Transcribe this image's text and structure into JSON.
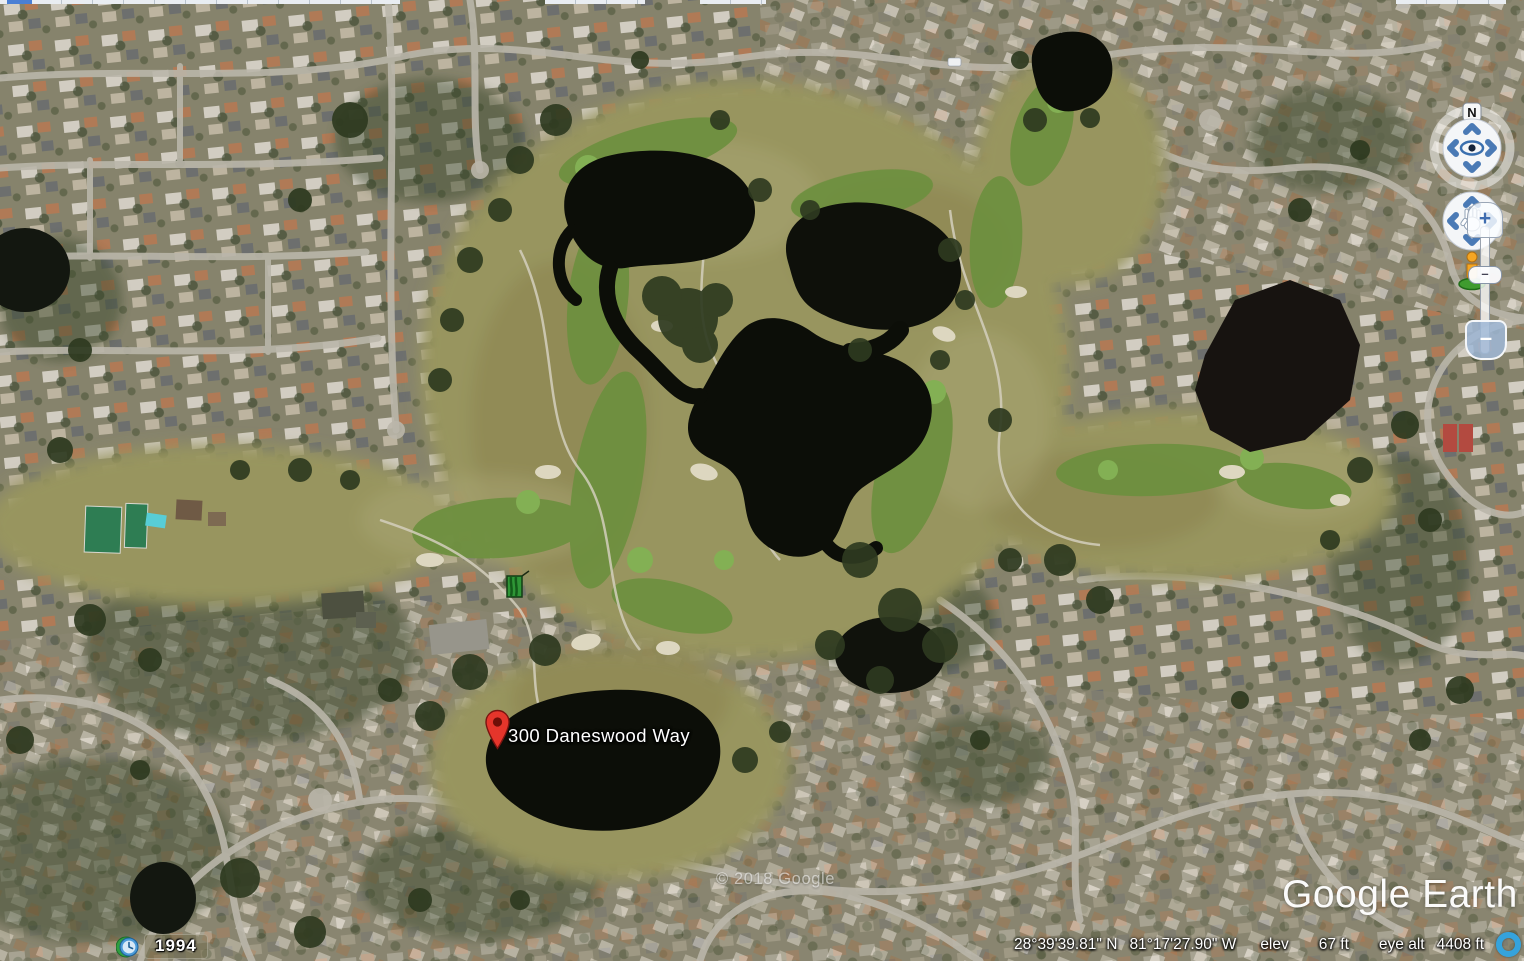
{
  "app": {
    "logo_text": "Google Earth",
    "copyright": "© 2018 Google"
  },
  "placemark": {
    "label": "300 Daneswood Way"
  },
  "navigation": {
    "compass_label": "N",
    "zoom_in_label": "+",
    "zoom_handle_label": "–",
    "zoom_out_label": "–"
  },
  "status_bar": {
    "imagery_year": "1994",
    "latitude": "28°39'39.81\" N",
    "longitude": "81°17'27.90\" W",
    "elevation_label": "elev",
    "elevation_value": "67 ft",
    "eye_alt_label": "eye alt",
    "eye_alt_value": "4408 ft"
  },
  "colors": {
    "nav_accent": "#4a7ab5",
    "pin_red": "#e5352b",
    "loading_ring": "#35a3dc",
    "water": "#0c0e08"
  }
}
